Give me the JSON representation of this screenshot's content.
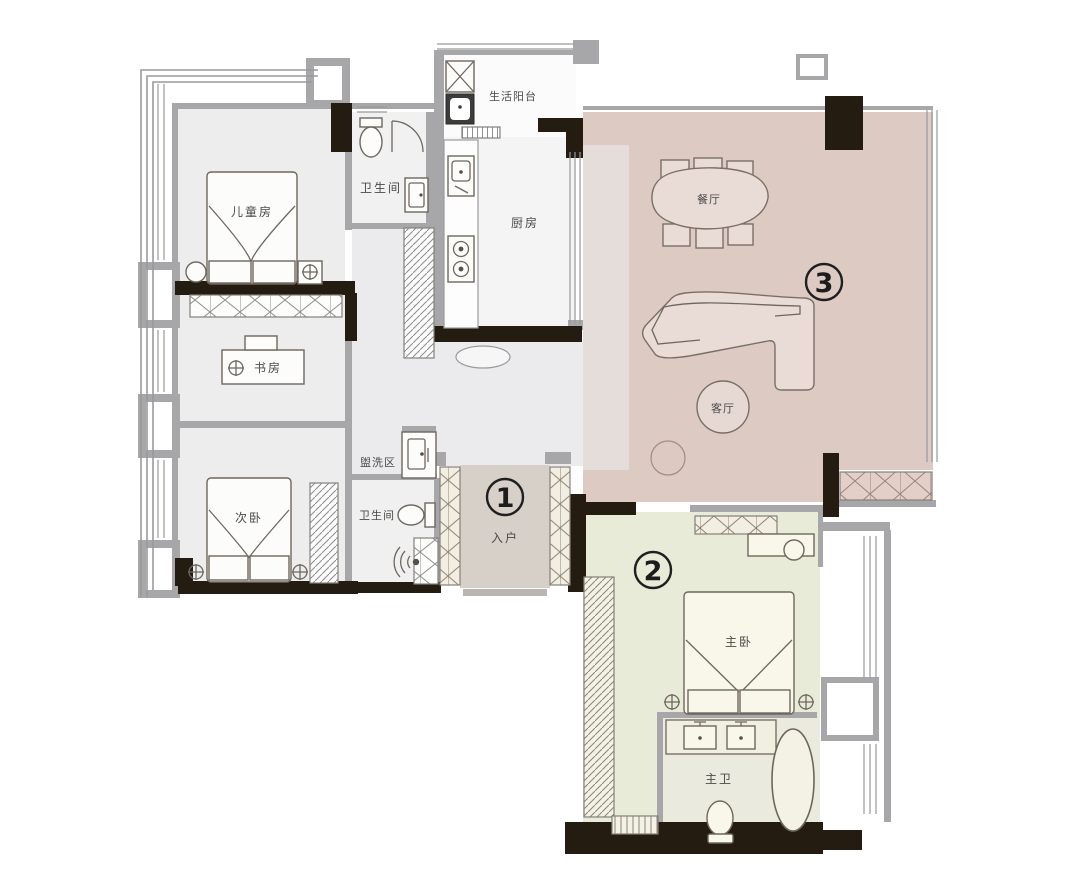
{
  "rooms": {
    "children_room": {
      "label": "儿童房"
    },
    "bath_top": {
      "label": "卫生间"
    },
    "service_balcony": {
      "label": "生活阳台"
    },
    "kitchen": {
      "label": "厨房"
    },
    "dining": {
      "label": "餐厅"
    },
    "living": {
      "label": "客厅"
    },
    "study": {
      "label": "书房"
    },
    "second_bedroom": {
      "label": "次卧"
    },
    "wash_area": {
      "label": "盥洗区"
    },
    "bath_lower": {
      "label": "卫生间"
    },
    "entry": {
      "label": "入户"
    },
    "master_bedroom": {
      "label": "主卧"
    },
    "master_bath": {
      "label": "主卫"
    }
  },
  "markers": {
    "one": "1",
    "two": "2",
    "three": "3"
  },
  "colors": {
    "living_floor": "#dccac3",
    "living_floor_light": "#e7e3e1",
    "master_floor": "#e9ebd9",
    "master_bath_floor": "#ebeadf",
    "entry_floor": "#d6d0c9",
    "room_floor": "#ededee",
    "hall_floor": "#ebebed",
    "bath_floor": "#f1f1f2",
    "kitchen_floor": "#f4f4f5",
    "wall_dark": "#241b11",
    "wall_gray": "#a7a7a9",
    "label_text": "#4a4a48"
  }
}
